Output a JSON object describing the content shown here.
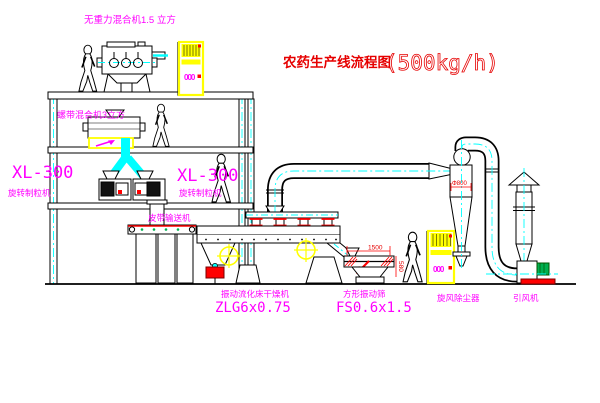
{
  "title": {
    "zh": "农药生产线流程图",
    "capacity": "(500kg/h)"
  },
  "labels": {
    "top_mixer": "无重力混合机1.5 立方",
    "floor2_mixer": "螺带混合机3立方",
    "granulator_model": "XL-300",
    "granulator_name": "旋转制粒机",
    "belt_conveyor": "皮带输送机",
    "dryer_name": "振动流化床干燥机",
    "dryer_model": "ZLG6x0.75",
    "sieve_name": "方形振动筛",
    "sieve_model": "FS0.6x1.5",
    "cyclone": "旋风除尘器",
    "fan": "引风机"
  },
  "dimensions": {
    "sieve_length": "1500",
    "sieve_height": "580",
    "cyclone_diameter": "Φ800"
  },
  "cabinet_display": "000",
  "colors": {
    "label_magenta": "#ff00ff",
    "title_red": "#e60000",
    "cabinet_yellow": "#ffff00",
    "centerline_cyan": "#00ffff",
    "valve_red": "#ff0000",
    "motor_green": "#00b050",
    "line_black": "#000000"
  }
}
